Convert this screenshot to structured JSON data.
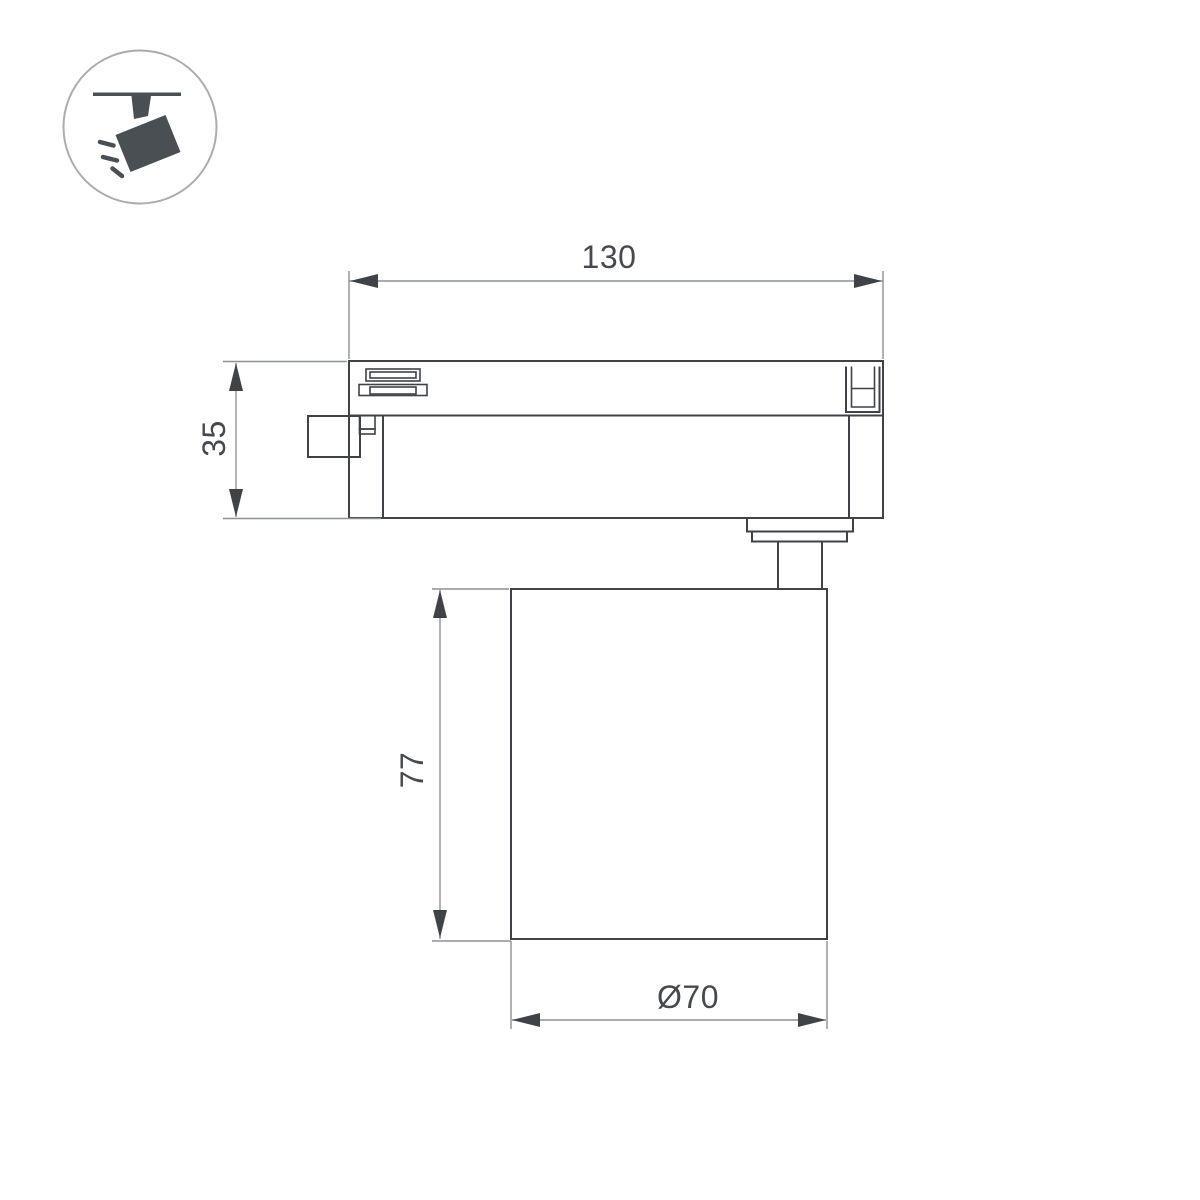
{
  "dimensions": {
    "adapter_width": "130",
    "adapter_height": "35",
    "body_height": "77",
    "body_diameter": "Ø70"
  },
  "icon": {
    "name": "track-spotlight-icon"
  },
  "colors": {
    "background": "#ffffff",
    "part_outline": "#3f4347",
    "dimension_lines": "#8e9296",
    "dimension_text": "#464a4e",
    "icon_fill": "#4a4f54",
    "icon_circle_stroke": "#a9adb1"
  }
}
